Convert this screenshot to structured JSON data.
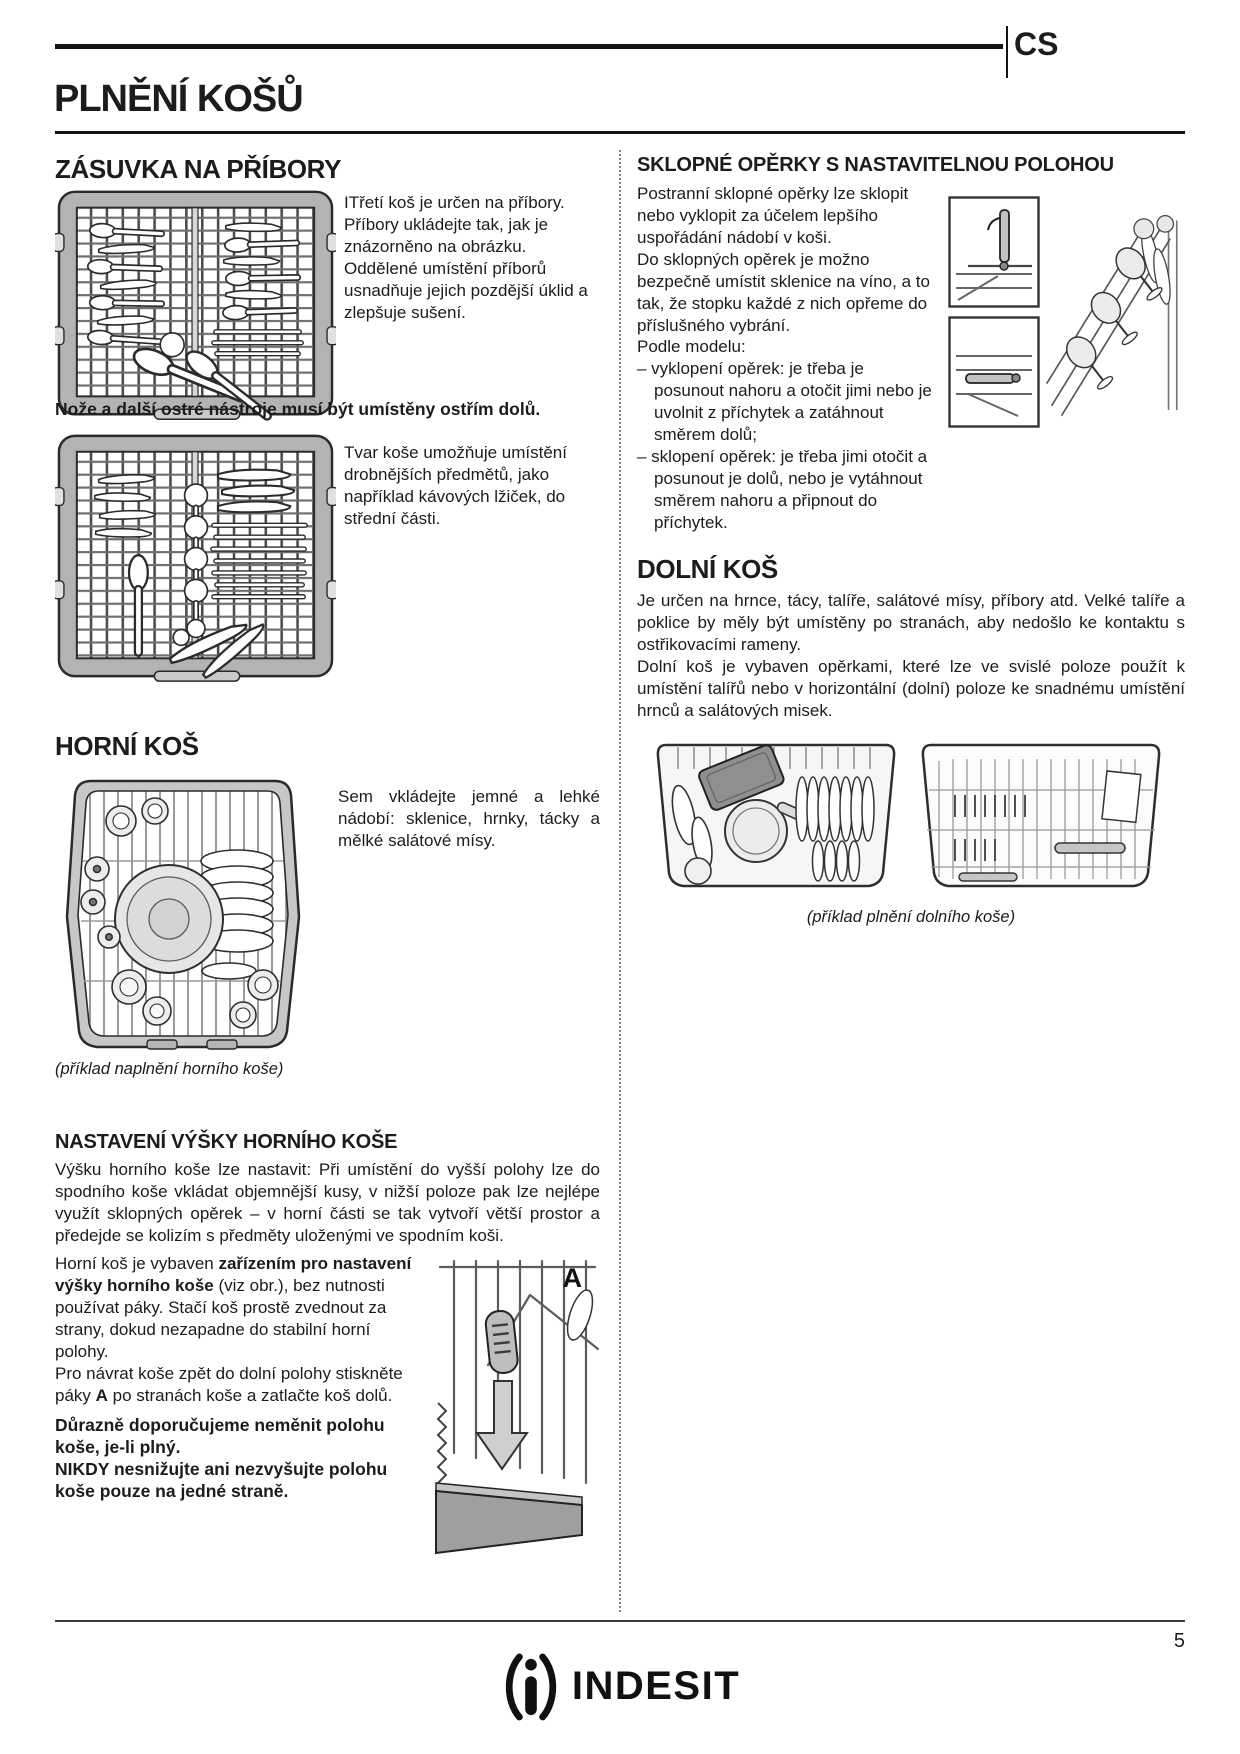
{
  "page": {
    "cs": "CS",
    "title": "PLNĚNÍ KOŠŮ",
    "page_number": "5",
    "brand": "INDESIT"
  },
  "cutlery": {
    "heading": "ZÁSUVKA NA PŘÍBORY",
    "p1": "ITřetí koš je určen na příbory. Příbory ukládejte tak, jak je znázorněno na obrázku.",
    "p2": "Oddělené umístění příborů usnadňuje jejich pozdější úklid a zlepšuje sušení.",
    "warning": "Nože a další ostré nástroje musí být umístěny ostřím dolů.",
    "p3": "Tvar koše umožňuje umístění drobnějších předmětů, jako například kávových lžiček, do střední části."
  },
  "upper": {
    "heading": "HORNÍ KOŠ",
    "p1": "Sem vkládejte jemné a lehké nádobí: sklenice, hrnky, tácky a mělké salátové mísy.",
    "caption": "(příklad naplnění horního koše)"
  },
  "height": {
    "heading": "NASTAVENÍ VÝŠKY HORNÍHO KOŠE",
    "p1": "Výšku horního koše lze nastavit: Při umístění do vyšší polohy lze do spodního koše vkládat objemnější kusy, v nižší poloze pak lze nejlépe využít sklopných opěrek – v horní části se tak vytvoří větší prostor a předejde se kolizím s předměty uloženými ve spodním koši.",
    "p2_pre": "Horní koš je vybaven ",
    "p2_bold": "zařízením pro nastavení výšky horního koše",
    "p2_post": " (viz obr.), bez nutnosti používat páky. Stačí koš prostě zvednout za strany, dokud nezapadne do stabilní horní polohy.",
    "p3_pre": "Pro návrat koše zpět do dolní polohy stiskněte páky ",
    "p3_bold": "A",
    "p3_post": " po stranách koše a zatlačte koš dolů.",
    "warn1": "Důrazně doporučujeme neměnit polohu koše, je-li plný.",
    "warn2": "NIKDY nesnižujte ani nezvyšujte polohu koše pouze na jedné straně.",
    "fig_label_a": "A"
  },
  "tipup": {
    "heading": "SKLOPNÉ OPĚRKY S NASTAVITELNOU POLOHOU",
    "p1": "Postranní sklopné opěrky lze sklopit nebo vyklopit za účelem lepšího uspořádání nádobí v koši.",
    "p2": "Do sklopných opěrek je možno bezpečně umístit sklenice na víno, a to tak, že stopku každé z nich opřeme do příslušného vybrání.",
    "p3": "Podle modelu:",
    "bullets": [
      "– vyklopení opěrek: je třeba je posunout nahoru a otočit jimi nebo je uvolnit z příchytek a zatáhnout směrem dolů;",
      "– sklopení opěrek: je třeba jimi otočit a posunout je dolů, nebo je vytáhnout směrem nahoru a připnout do příchytek."
    ]
  },
  "lower": {
    "heading": "DOLNÍ KOŠ",
    "p1": "Je určen na hrnce, tácy, talíře, salátové mísy, příbory atd. Velké talíře a poklice by měly být umístěny po stranách, aby nedošlo ke kontaktu s ostřikovacími rameny.",
    "p2": "Dolní koš je vybaven opěrkami, které lze ve svislé poloze použít k umístění talířů nebo v horizontální (dolní) poloze ke snadnému umístění hrnců a salátových misek.",
    "caption": "(příklad plnění dolního koše)"
  },
  "colors": {
    "ink": "#131313",
    "basket_gray": "#b5b5b5",
    "light_gray": "#e6e6e6"
  }
}
